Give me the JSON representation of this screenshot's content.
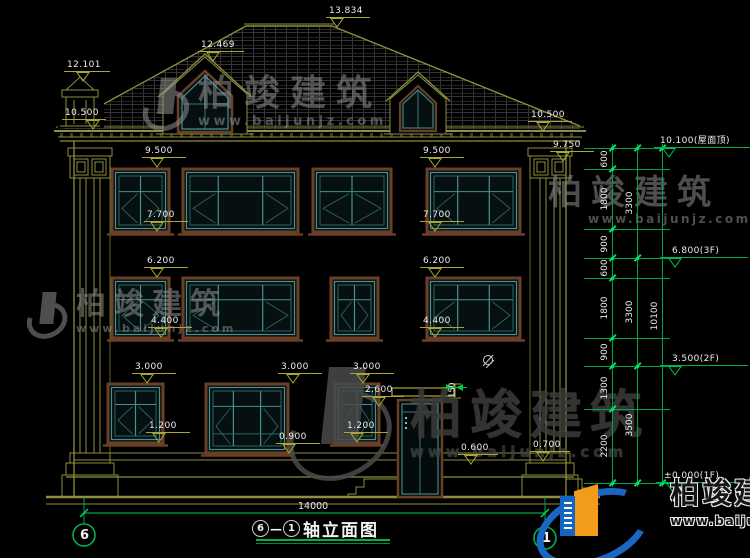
{
  "colors": {
    "line_olive": "#8e8e3e",
    "marker_yellow": "#aaa636",
    "cad_green": "#00b050",
    "window_teal": "#498f8f",
    "frame_brown": "#6b3f26",
    "logo_blue": "#1a66c4",
    "logo_orange": "#f39c1b"
  },
  "watermark": {
    "brand": "柏竣建筑",
    "url": "www.baijunjz.com"
  },
  "title_bar": {
    "axis_start": "6",
    "separator": "—",
    "axis_end": "1",
    "name": "轴立面图"
  },
  "overall_width_dim": "14000",
  "axis_bubbles": {
    "left": "6",
    "right": "1"
  },
  "canopy_dim": "150",
  "elevation_markers": [
    {
      "text": "13.834",
      "x": 326,
      "line_y": 18,
      "w": 44,
      "tri_x": 330
    },
    {
      "text": "12.469",
      "x": 198,
      "line_y": 52,
      "w": 46,
      "tri_x": 206
    },
    {
      "text": "12.101",
      "x": 64,
      "line_y": 72,
      "w": 46,
      "tri_x": 76
    },
    {
      "text": "10.500",
      "x": 62,
      "line_y": 120,
      "w": 44,
      "tri_x": 86
    },
    {
      "text": "10.500",
      "x": 528,
      "line_y": 122,
      "w": 44,
      "tri_x": 536
    },
    {
      "text": "9.750",
      "x": 550,
      "line_y": 152,
      "w": 44,
      "tri_x": 556
    },
    {
      "text": "9.500",
      "x": 142,
      "line_y": 158,
      "w": 44,
      "tri_x": 150
    },
    {
      "text": "9.500",
      "x": 420,
      "line_y": 158,
      "w": 44,
      "tri_x": 428
    },
    {
      "text": "7.700",
      "x": 144,
      "line_y": 222,
      "w": 44,
      "tri_x": 150
    },
    {
      "text": "7.700",
      "x": 420,
      "line_y": 222,
      "w": 44,
      "tri_x": 428
    },
    {
      "text": "6.200",
      "x": 144,
      "line_y": 268,
      "w": 44,
      "tri_x": 150
    },
    {
      "text": "6.200",
      "x": 420,
      "line_y": 268,
      "w": 44,
      "tri_x": 428
    },
    {
      "text": "4.400",
      "x": 148,
      "line_y": 328,
      "w": 44,
      "tri_x": 154
    },
    {
      "text": "4.400",
      "x": 420,
      "line_y": 328,
      "w": 44,
      "tri_x": 428
    },
    {
      "text": "3.000",
      "x": 132,
      "line_y": 374,
      "w": 44,
      "tri_x": 140
    },
    {
      "text": "3.000",
      "x": 278,
      "line_y": 374,
      "w": 44,
      "tri_x": 286
    },
    {
      "text": "3.000",
      "x": 350,
      "line_y": 374,
      "w": 44,
      "tri_x": 356
    },
    {
      "text": "1.200",
      "x": 146,
      "line_y": 433,
      "w": 44,
      "tri_x": 152
    },
    {
      "text": "1.200",
      "x": 344,
      "line_y": 433,
      "w": 44,
      "tri_x": 350
    },
    {
      "text": "0.900",
      "x": 276,
      "line_y": 444,
      "w": 44,
      "tri_x": 282
    },
    {
      "text": "2.600",
      "x": 362,
      "line_y": 397,
      "w": 42,
      "tri_x": 372
    },
    {
      "text": "0.600",
      "x": 458,
      "line_y": 455,
      "w": 40,
      "tri_x": 464
    },
    {
      "text": "0.700",
      "x": 530,
      "line_y": 452,
      "w": 40,
      "tri_x": 536
    }
  ],
  "level_markers_green": [
    {
      "text": "10.100(屋面顶)",
      "x": 660,
      "text_y": 126,
      "line_y": 148,
      "x1": 654,
      "x2": 750,
      "tri_x": 662
    },
    {
      "text": "6.800(3F)",
      "x": 672,
      "text_y": 236,
      "line_y": 258,
      "x1": 660,
      "x2": 748,
      "tri_x": 668
    },
    {
      "text": "3.500(2F)",
      "x": 672,
      "text_y": 344,
      "line_y": 366,
      "x1": 660,
      "x2": 748,
      "tri_x": 668
    },
    {
      "text": "±0.000(1F)",
      "x": 664,
      "text_y": 461,
      "line_y": 483,
      "x1": 656,
      "x2": 748,
      "tri_x": 666
    }
  ],
  "dimension_chain": {
    "ext_x1": 584,
    "ext_x2": 670,
    "columns": [
      {
        "x": 612,
        "breaks": [
          148,
          169,
          229,
          258,
          278,
          338,
          366,
          409,
          483
        ],
        "labels": [
          "600",
          "1800",
          "900",
          "600",
          "1800",
          "900",
          "1300",
          "2200"
        ]
      },
      {
        "x": 637,
        "breaks": [
          148,
          258,
          366,
          483
        ],
        "labels": [
          "3300",
          "3300",
          "3500"
        ]
      },
      {
        "x": 662,
        "breaks": [
          148,
          483
        ],
        "labels": [
          "10100"
        ]
      }
    ]
  }
}
